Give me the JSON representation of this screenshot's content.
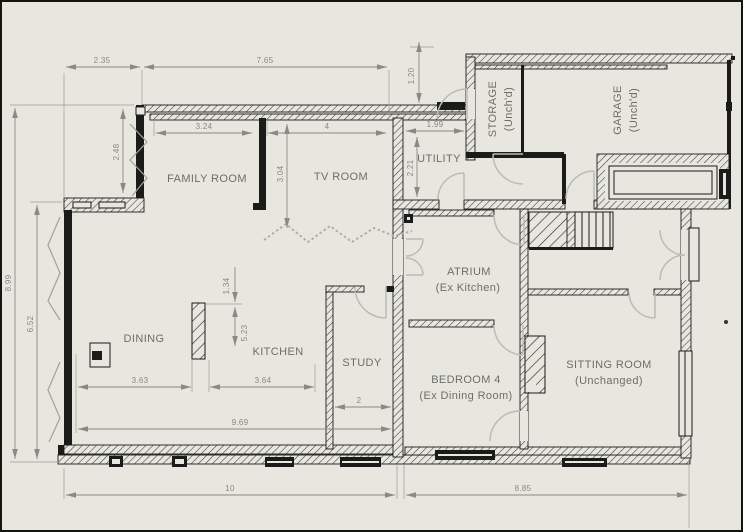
{
  "drawing": {
    "type": "floor-plan",
    "background": "#e7e6df",
    "wall_color": "#1b1b1a",
    "dimension_color": "#8a8a85",
    "label_color": "#6e6e68",
    "door_arc_color": "#bcbcb5"
  },
  "rooms": {
    "family": {
      "name": "FAMILY ROOM",
      "sub": ""
    },
    "tv": {
      "name": "TV ROOM",
      "sub": ""
    },
    "utility": {
      "name": "UTILITY",
      "sub": ""
    },
    "storage": {
      "name": "STORAGE",
      "sub": "(Unch'd)"
    },
    "garage": {
      "name": "GARAGE",
      "sub": "(Unch'd)"
    },
    "dining": {
      "name": "DINING",
      "sub": ""
    },
    "kitchen": {
      "name": "KITCHEN",
      "sub": ""
    },
    "study": {
      "name": "STUDY",
      "sub": ""
    },
    "atrium": {
      "name": "ATRIUM",
      "sub": "(Ex Kitchen)"
    },
    "bedroom4": {
      "name": "BEDROOM 4",
      "sub": "(Ex Dining Room)"
    },
    "sitting": {
      "name": "SITTING ROOM",
      "sub": "(Unchanged)"
    }
  },
  "dims": {
    "v235": "2.35",
    "v765": "7.65",
    "v120": "1.20",
    "v324": "3.24",
    "v4": "4",
    "v199": "1.99",
    "v221": "2.21",
    "v248": "2.48",
    "v304": "3.04",
    "v899": "8.99",
    "v652": "6.52",
    "v134": "1.34",
    "v523": "5.23",
    "v363": "3.63",
    "v364": "3.64",
    "v2": "2",
    "v969": "9.69",
    "v10": "10",
    "v885": "8.85"
  }
}
